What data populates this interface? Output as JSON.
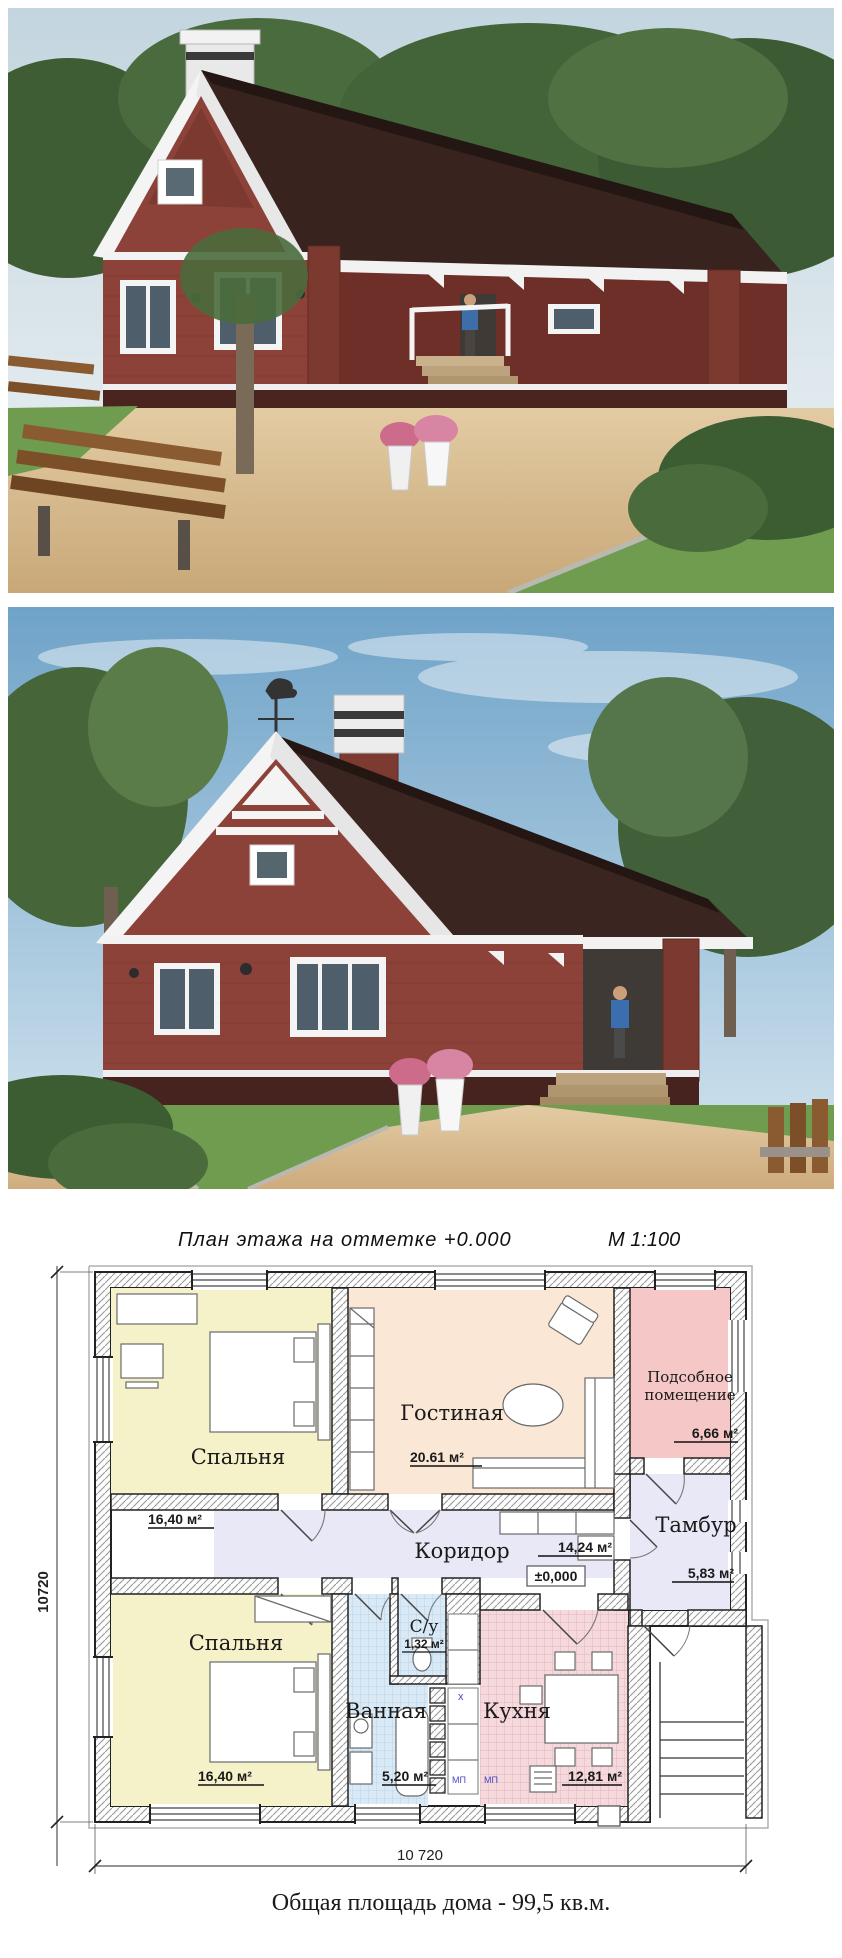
{
  "plan": {
    "title": "План  этажа  на отметке +0.000",
    "scale": "М 1:100",
    "rooms": {
      "bedroom1": {
        "name": "Спальня",
        "area": "16,40 м²"
      },
      "living": {
        "name": "Гостиная",
        "area": "20.61 м²"
      },
      "utility": {
        "name_line1": "Подсобное",
        "name_line2": "помещение",
        "area": "6,66 м²"
      },
      "tambur": {
        "name": "Тамбур",
        "area": "5,83 м²"
      },
      "corridor": {
        "name": "Коридор",
        "area": "14,24 м²",
        "level": "±0,000"
      },
      "bedroom2": {
        "name": "Спальня",
        "area": "16,40 м²"
      },
      "bathroom": {
        "name": "Ванная",
        "area": "5,20 м²"
      },
      "wc": {
        "name": "С/у",
        "area": "1,32 м²"
      },
      "kitchen": {
        "name": "Кухня",
        "area": "12,81 м²"
      }
    },
    "marks": {
      "mp1": "МП",
      "mp2": "МП",
      "x_mark": "х"
    },
    "dimensions": {
      "bottom": "10 720",
      "left": "10720"
    },
    "colors": {
      "bedroom": "#f5f1c9",
      "living": "#fbe7d5",
      "utility": "#f6c7c7",
      "hall": "#e8e8f6",
      "bath": "#d9e9f6",
      "kitchen": "#f6d9dc",
      "wall_hatch": "#9a9a9a",
      "line": "#222222",
      "blue_label": "#4646c8"
    }
  },
  "renders": {
    "palette": {
      "brick": "#8c4238",
      "brick_dark": "#6e2f28",
      "roof": "#3a2520",
      "trim": "#ffffff",
      "grass": "#6f9c4e",
      "sky1": "#7aa6c9",
      "sky2": "#d8e7f0",
      "paving": "#d7b88c",
      "foliage": "#46663a"
    }
  },
  "footer": {
    "caption": "Общая площадь дома - 99,5 кв.м."
  }
}
